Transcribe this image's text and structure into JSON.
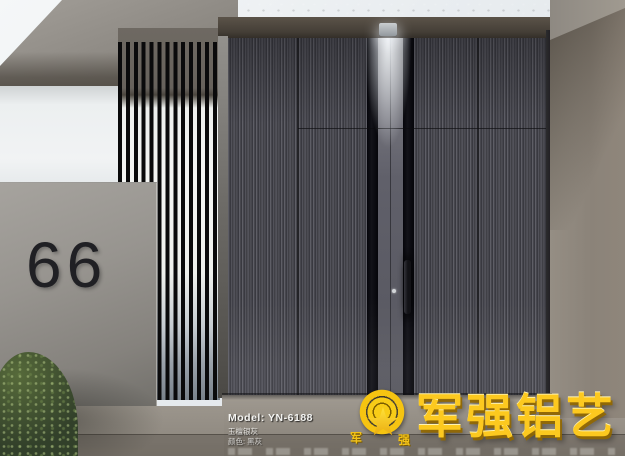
{
  "scene": {
    "house_number": "66"
  },
  "watermark": {
    "model": "Model: YN-6188",
    "finish_line": "玉檀银灰",
    "color_line": "颜色: 黑灰"
  },
  "brand": {
    "name": "军强铝艺",
    "char_left": "军",
    "char_right": "强"
  },
  "colors": {
    "brand_gold": "#f6c51a",
    "door_panel_grey": "#515158",
    "glass_strip_black": "#0d0d10",
    "concrete": "#8f8b85",
    "slat_black": "#0a0a0b",
    "slat_background": "#f2f3f1",
    "downlight": "#eef2f6",
    "hedge_green": "#32402a",
    "number_dark": "#202024"
  }
}
